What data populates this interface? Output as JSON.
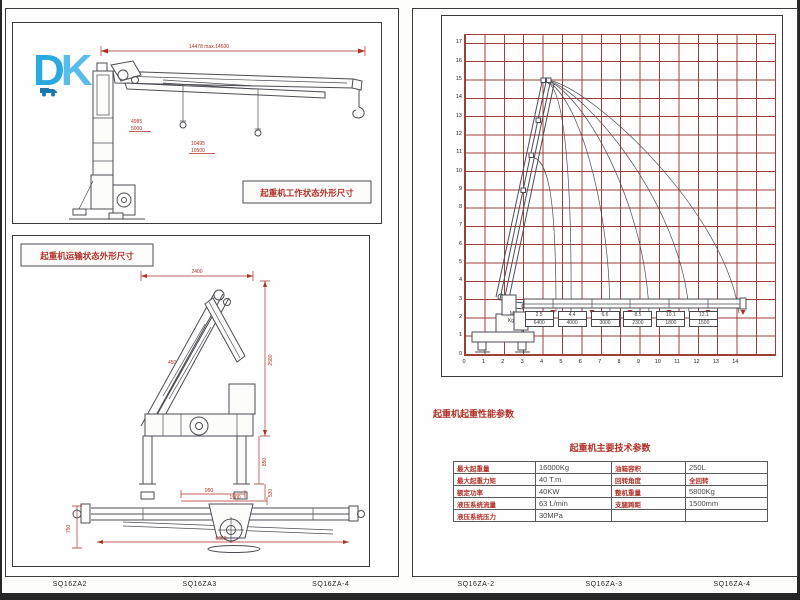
{
  "logo": {
    "d": "D",
    "k": "K"
  },
  "left_panel": {
    "working_drawing": {
      "title": "起重机工作状态外形尺寸",
      "dim_total": "14478  max.14500",
      "dim_mid_top": "4985",
      "dim_mid_top2": "5000",
      "dim_mid_bot": "10495",
      "dim_mid_bot2": "10500"
    },
    "transport_drawing": {
      "title": "起重机运输状态外形尺寸",
      "dim_width": "2400",
      "dim_height": "2580",
      "dim_leg": "850",
      "dim_pad": "530",
      "dim_mid": "450"
    },
    "outrigger_view": {
      "dim_a": "950",
      "dim_b": "1900",
      "dim_side": "750",
      "dim_span": "6600"
    },
    "footer_labels": [
      "SQ16ZA2",
      "SQ16ZA3",
      "SQ16ZA-4"
    ]
  },
  "right_panel": {
    "perf_title": "起重机起重性能参数",
    "spec_title": "起重机主要技术参数",
    "table": {
      "rows": [
        [
          {
            "t": "最大起重量",
            "lab": true
          },
          {
            "t": "16000Kg"
          },
          {
            "t": "油箱容积",
            "lab": true
          },
          {
            "t": "250L"
          }
        ],
        [
          {
            "t": "最大起重力矩",
            "lab": true
          },
          {
            "t": "40 T.m"
          },
          {
            "t": "回转角度",
            "lab": true
          },
          {
            "t": "全回转",
            "red": true
          }
        ],
        [
          {
            "t": "额定功率",
            "lab": true
          },
          {
            "t": "40KW"
          },
          {
            "t": "整机重量",
            "lab": true
          },
          {
            "t": "5800Kg"
          }
        ],
        [
          {
            "t": "液压系统流量",
            "lab": true
          },
          {
            "t": "63 L/min"
          },
          {
            "t": "支腿跨距",
            "lab": true
          },
          {
            "t": "1500mm"
          }
        ],
        [
          {
            "t": "液压系统压力",
            "lab": true
          },
          {
            "t": "30MPa"
          },
          {
            "t": ""
          },
          {
            "t": ""
          }
        ]
      ]
    },
    "footer_labels": [
      "SQ16ZA-2",
      "SQ16ZA-3",
      "SQ16ZA-4"
    ]
  },
  "chart_data": {
    "type": "line",
    "title": "起重机起重性能参数 (crane working range / load chart)",
    "grid": true,
    "grid_color": "#9e3f3a",
    "xlim": [
      0,
      16
    ],
    "ylim": [
      0,
      17.5
    ],
    "x_ticks": [
      0,
      1,
      2,
      3,
      4,
      5,
      6,
      7,
      8,
      9,
      10,
      11,
      12,
      13,
      14
    ],
    "y_ticks": [
      17,
      16,
      15,
      14,
      13,
      12,
      11,
      10,
      9,
      8,
      7,
      6,
      5,
      4,
      3,
      2,
      1,
      0
    ],
    "unit_labels": {
      "radius": "M",
      "load": "Kg"
    },
    "load_points": [
      {
        "radius_m": "2.5",
        "load_kg": "6400"
      },
      {
        "radius_m": "4.4",
        "load_kg": "4000"
      },
      {
        "radius_m": "6.6",
        "load_kg": "3000"
      },
      {
        "radius_m": "8.5",
        "load_kg": "2300"
      },
      {
        "radius_m": "10.1",
        "load_kg": "1800"
      },
      {
        "radius_m": "12.1",
        "load_kg": "1500"
      }
    ],
    "legend_position": "none",
    "series_note": "envelope curves for telescopic boom extension stages"
  }
}
